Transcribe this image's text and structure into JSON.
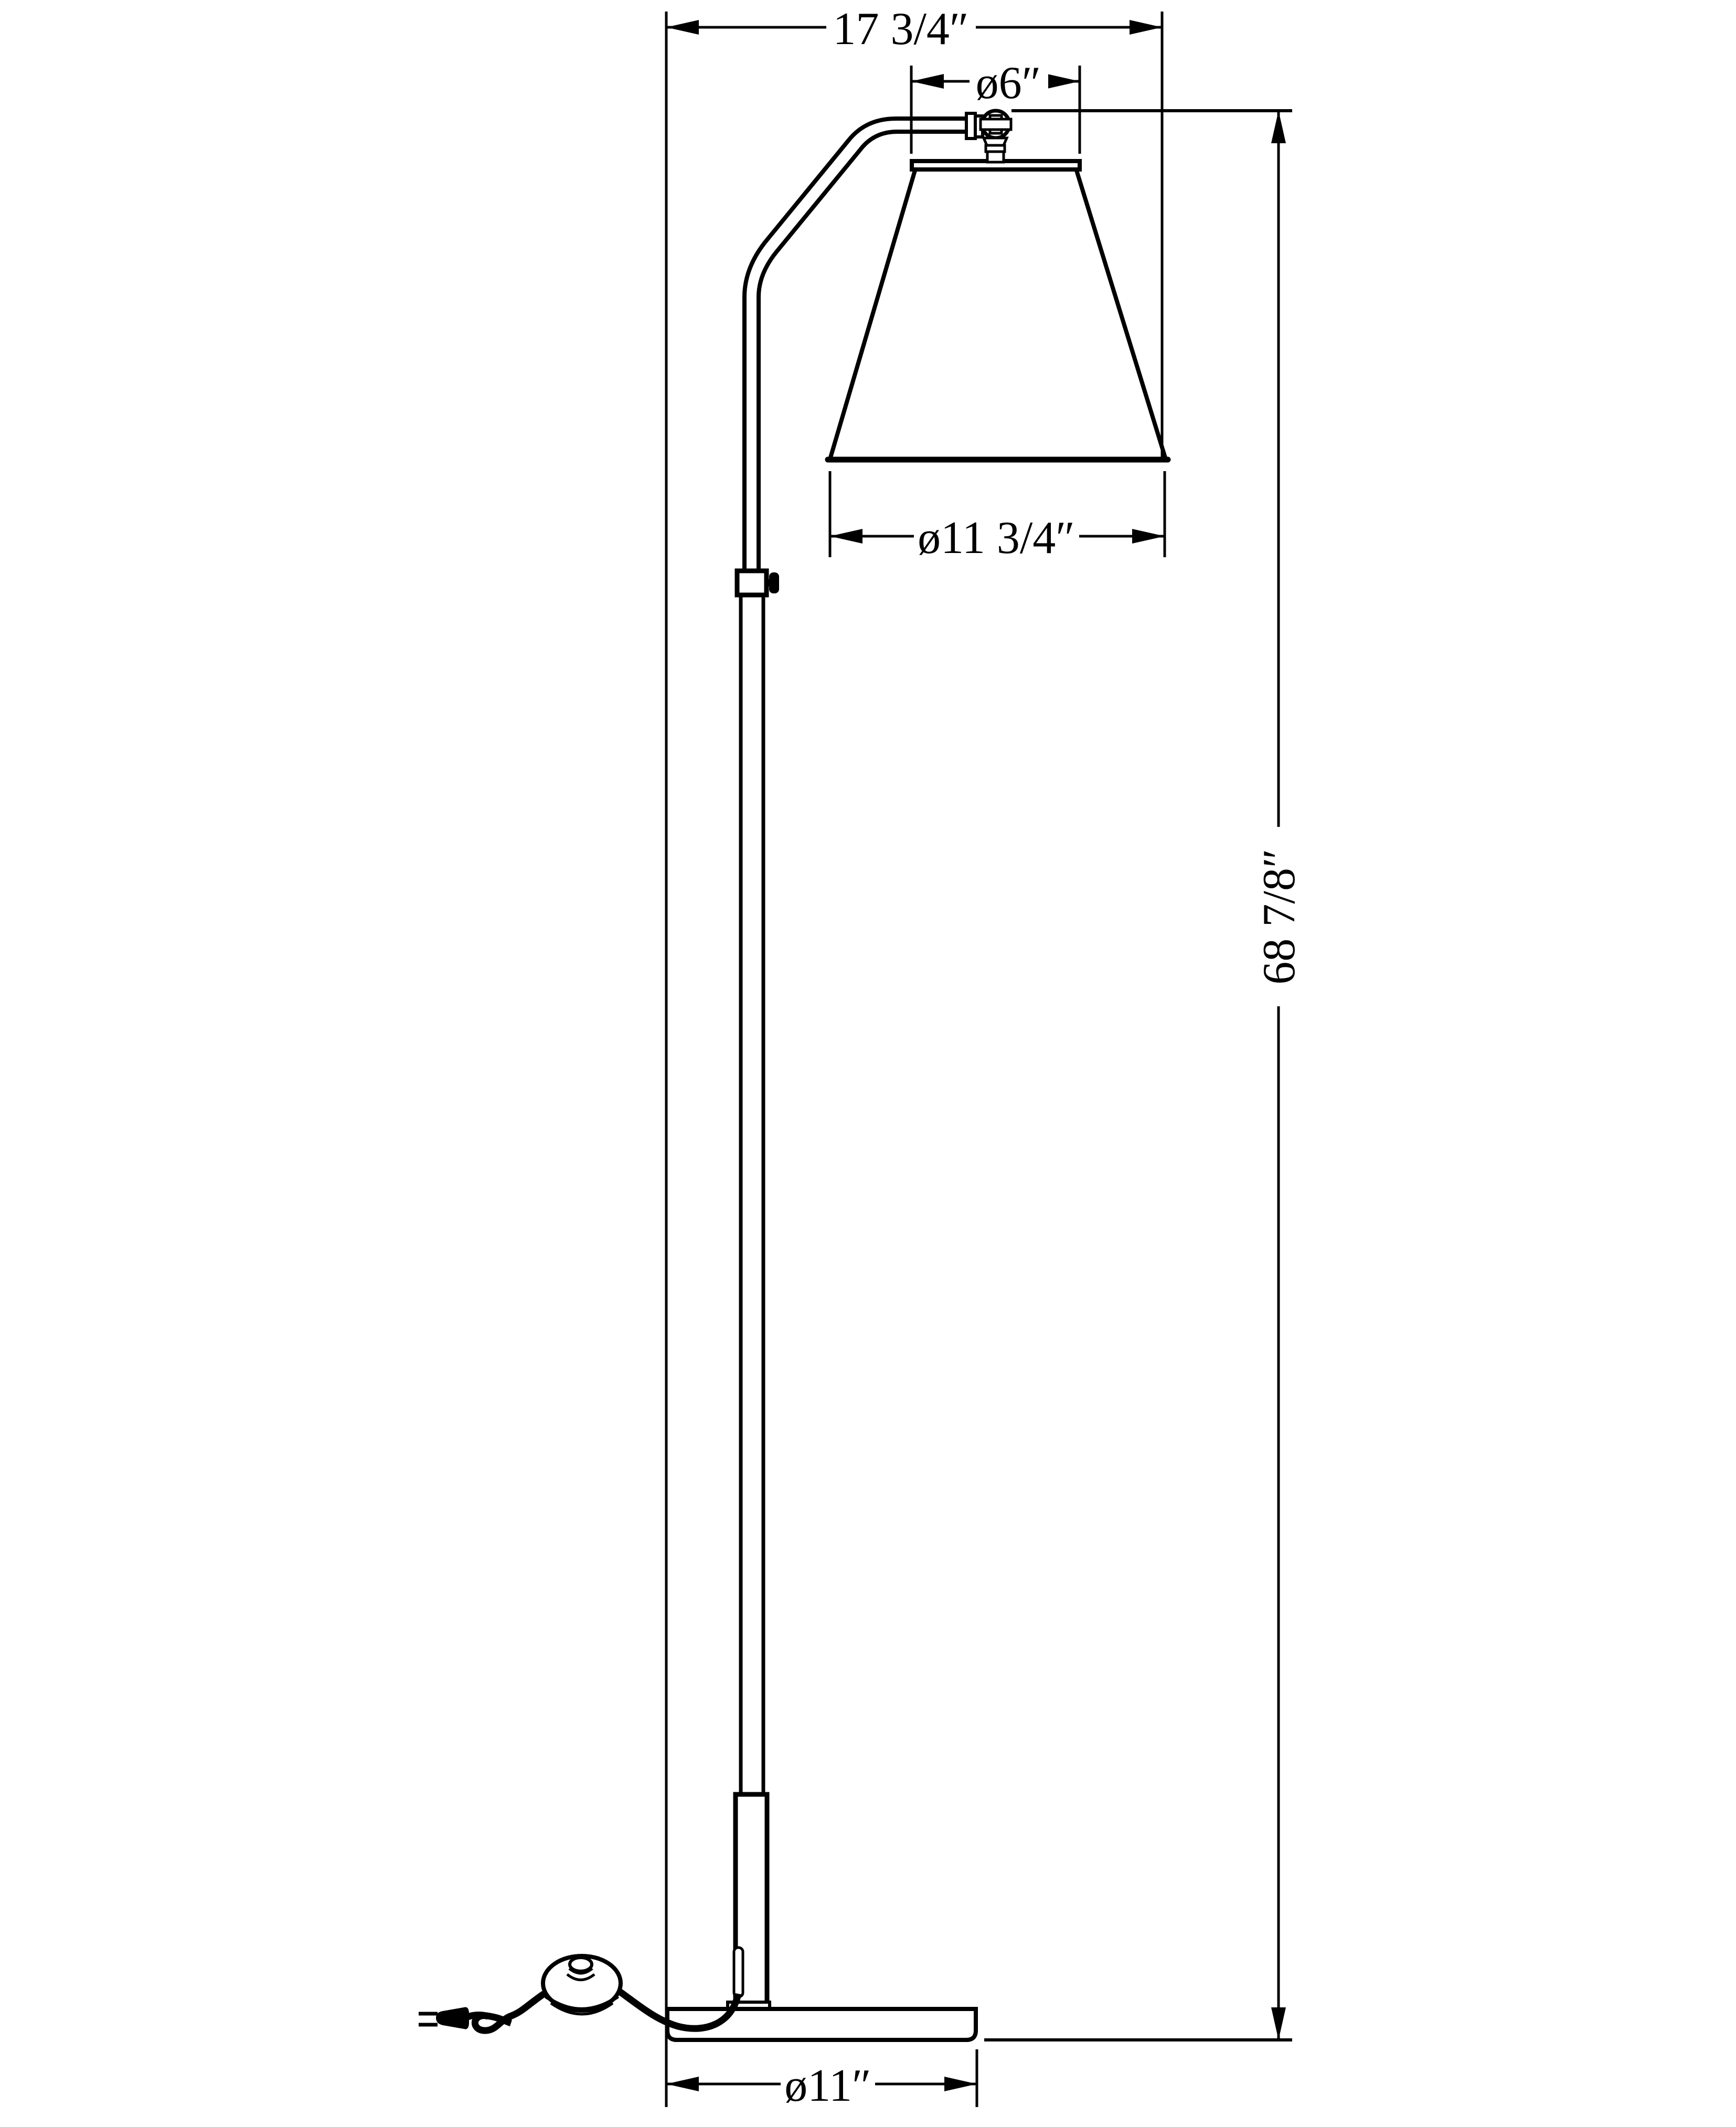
{
  "drawing": {
    "title": "floor-lamp-dimension-drawing",
    "background_color": "#ffffff",
    "line_color": "#000000",
    "dimensions": {
      "overall_width": {
        "label": "17 3/4″"
      },
      "shade_top_diameter": {
        "label": "ø6″"
      },
      "shade_bottom_diameter": {
        "label": "ø11 3/4″"
      },
      "overall_height": {
        "label": "68 7/8″"
      },
      "base_diameter": {
        "label": "ø11″"
      }
    }
  }
}
